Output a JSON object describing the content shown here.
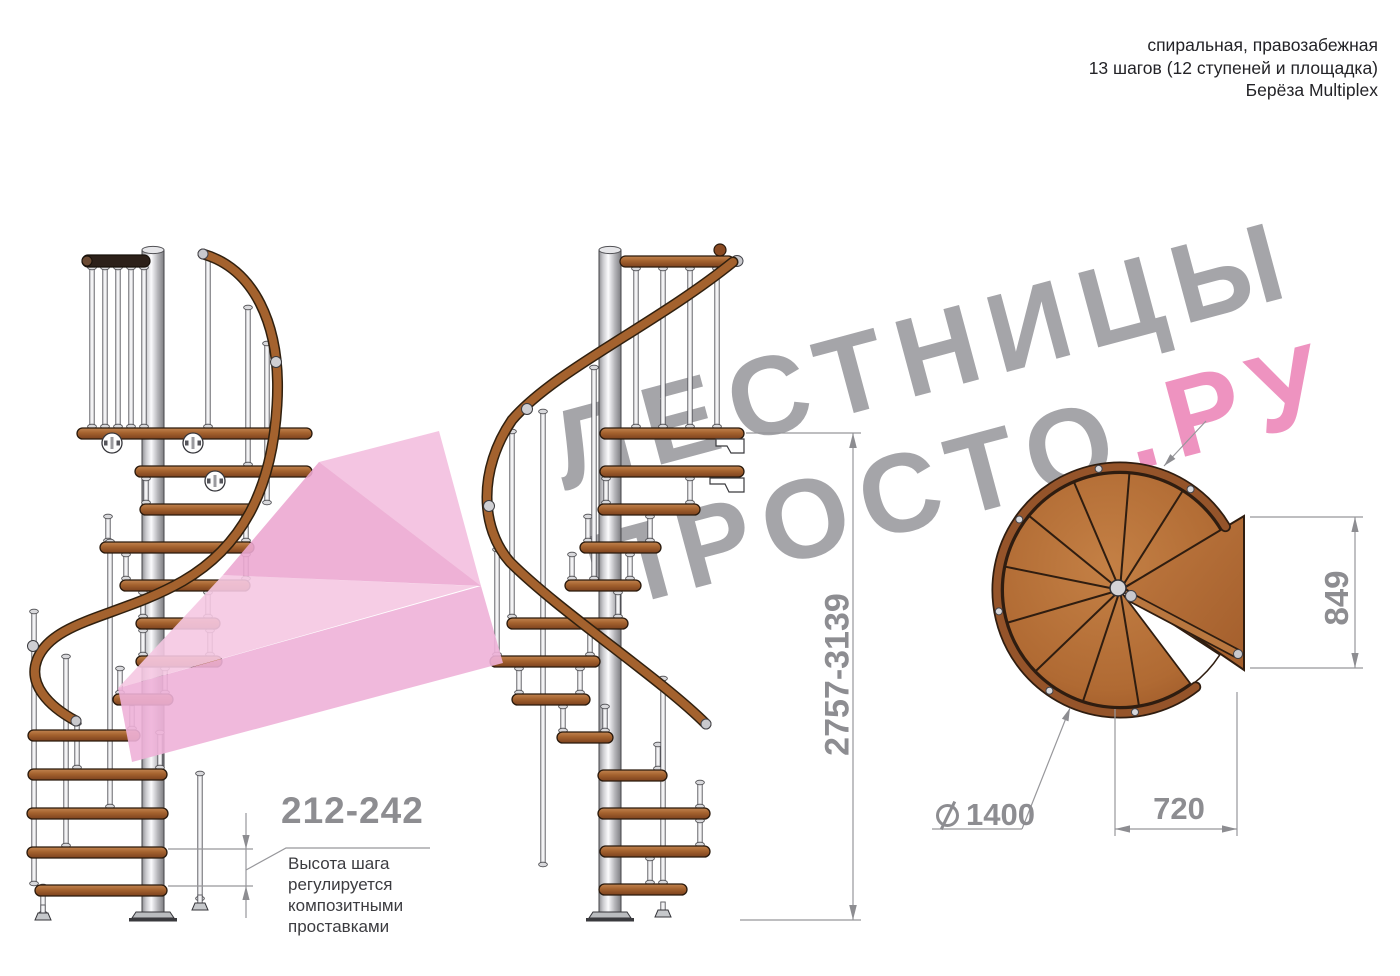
{
  "header": {
    "line1": "спиральная, правозабежная",
    "line2": "13 шагов (12 ступеней и площадка)",
    "line3": "Берёза Multiplex"
  },
  "watermark": {
    "word1": "ЛЕСТНИЦЫ",
    "word2": "ПРОСТО",
    "word3": ".РУ"
  },
  "dimensions": {
    "step_height": "212-242",
    "step_height_note": [
      "Высота шага",
      "регулируется",
      "композитными",
      "проставками"
    ],
    "total_height": "2757-3139",
    "platform_depth": "849",
    "platform_width": "720",
    "diameter": "1400"
  },
  "colors": {
    "wood": "#a4622e",
    "wood_dark": "#8a4a22",
    "metal": "#d9d9dc",
    "dimension_gray": "#8d8d91",
    "watermark_gray": "#a5a5a9",
    "watermark_pink": "#ee93c0",
    "logo_pink": "#f2b8da"
  }
}
